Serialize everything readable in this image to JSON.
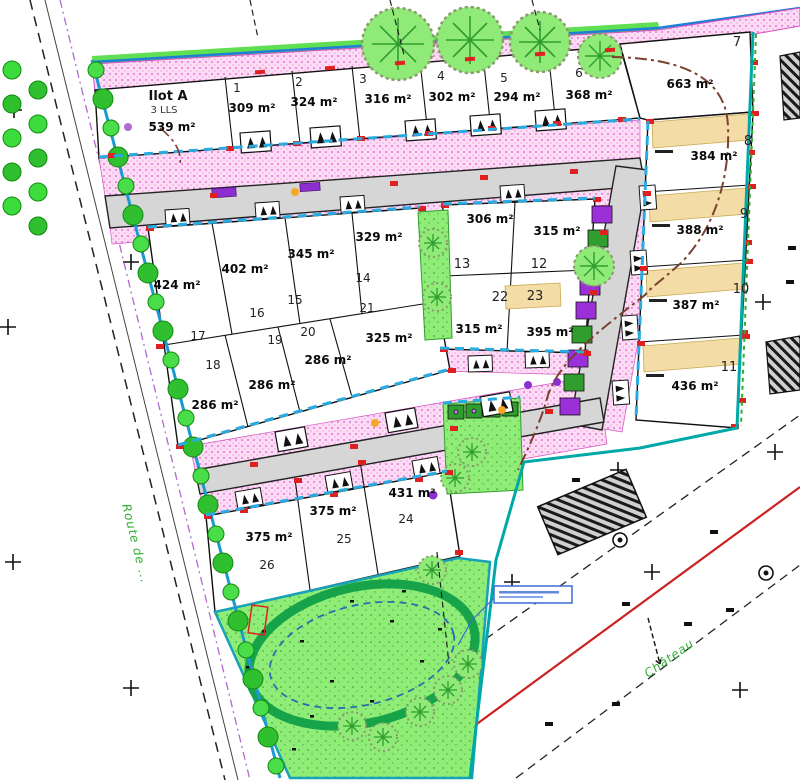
{
  "plan": {
    "ilot_a": {
      "name": "Ilot A",
      "units": "3 LLS",
      "area": "539 m²"
    },
    "lots": [
      {
        "num": "1",
        "area": "309 m²"
      },
      {
        "num": "2",
        "area": "324 m²"
      },
      {
        "num": "3",
        "area": "316 m²"
      },
      {
        "num": "4",
        "area": "302 m²"
      },
      {
        "num": "5",
        "area": "294 m²"
      },
      {
        "num": "6",
        "area": "368 m²"
      },
      {
        "num": "7",
        "area": "663 m²"
      },
      {
        "num": "8",
        "area": "384 m²"
      },
      {
        "num": "9",
        "area": "388 m²"
      },
      {
        "num": "10",
        "area": "387 m²"
      },
      {
        "num": "11",
        "area": "436 m²"
      },
      {
        "num": "12",
        "area": "315 m²"
      },
      {
        "num": "13",
        "area": "306 m²"
      },
      {
        "num": "14",
        "area": "329 m²"
      },
      {
        "num": "15",
        "area": "345 m²"
      },
      {
        "num": "16",
        "area": "402 m²"
      },
      {
        "num": "17",
        "area": "424 m²"
      },
      {
        "num": "18",
        "area": "286 m²"
      },
      {
        "num": "19",
        "area": "286 m²"
      },
      {
        "num": "20",
        "area": "286 m²"
      },
      {
        "num": "21",
        "area": "325 m²"
      },
      {
        "num": "22",
        "area": "315 m²"
      },
      {
        "num": "23",
        "area": "395 m²"
      },
      {
        "num": "24",
        "area": "431 m²"
      },
      {
        "num": "25",
        "area": "375 m²"
      },
      {
        "num": "26",
        "area": "375 m²"
      }
    ],
    "streets": {
      "west_road": "Route de ...",
      "southeast_road": "Château"
    },
    "colors": {
      "boundary_blue": "#1b9ad2",
      "frontage_cyan": "#29abe2",
      "pink_strip": "#fcdcf5",
      "road_gray": "#d6d6d6",
      "green_space": "#8fec77",
      "basin_ring_green": "#16a34a",
      "water_blue_dash": "#2b6cb0",
      "marker_red": "#e02020",
      "parking_purple": "#8b2fd0",
      "utility_brown": "#7a4030",
      "road_axis_red": "#cc2222",
      "tan_building_zone": "#f3dca6",
      "east_boundary_teal": "#00a8a8"
    }
  }
}
